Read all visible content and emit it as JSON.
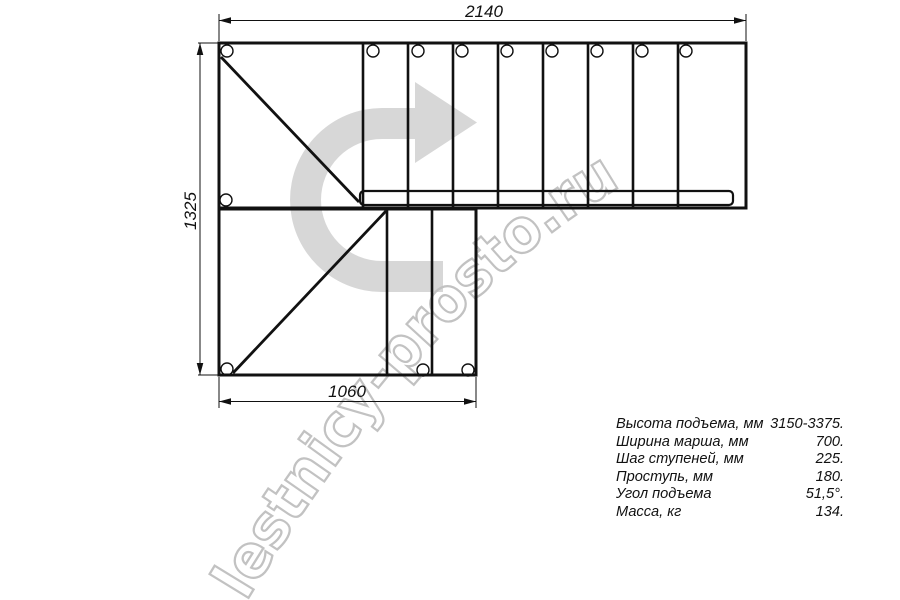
{
  "watermark": {
    "text": "lestnicy-prosto.ru"
  },
  "dims": {
    "top": "2140",
    "left": "1325",
    "bottom": "1060"
  },
  "specs": {
    "rows": [
      {
        "label": "Высота подъема, мм",
        "value": "3150-3375."
      },
      {
        "label": "Ширина марша, мм",
        "value": "700."
      },
      {
        "label": "Шаг ступеней, мм",
        "value": "225."
      },
      {
        "label": "Проступь, мм",
        "value": "180."
      },
      {
        "label": "Угол подъема",
        "value": "51,5°."
      },
      {
        "label": "Масса, кг",
        "value": "134."
      }
    ]
  },
  "colors": {
    "line": "#111111",
    "arrow_fill": "#d7d7d7",
    "watermark_stroke": "#c2c2c2",
    "background": "#ffffff"
  }
}
